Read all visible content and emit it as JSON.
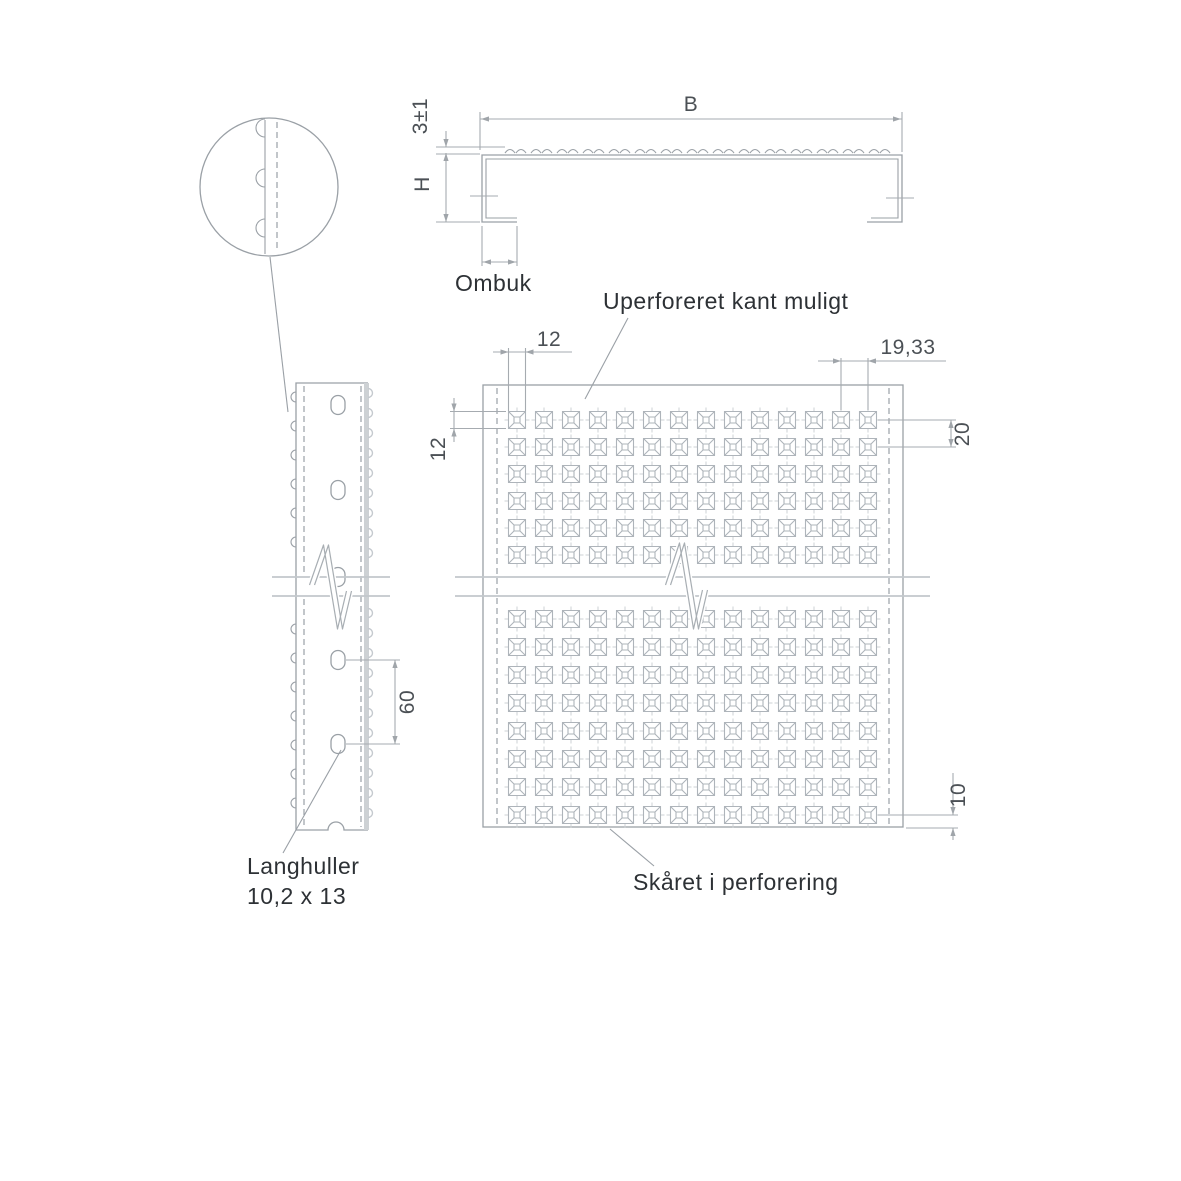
{
  "labels": {
    "ombuk": "Ombuk",
    "unperforated_edge": "Uperforeret kant muligt",
    "cut_in_perforation": "Skåret i perforering",
    "slotted_holes_line1": "Langhuller",
    "slotted_holes_line2": "10,2 x 13"
  },
  "dimensions": {
    "profile_width": "B",
    "rib_height": "3±1",
    "profile_height": "H",
    "perf_width": "12",
    "perf_height": "12",
    "perf_pitch": "19,33",
    "row_pitch": "20",
    "slot_spacing": "60",
    "bottom_edge_distance": "10"
  },
  "colors": {
    "background": "#ffffff",
    "outline": "#9aa0a6",
    "dimension_line": "#a6abb0",
    "perforation": "#aeb4ba",
    "centerline_tick": "#cdd1d4",
    "break_band": "#c3c8cc",
    "label_text": "#2d3135",
    "dimension_text": "#4b5055"
  },
  "perf_grid": {
    "columns": 14,
    "col_start_x": 517,
    "col_pitch": 27,
    "top_row_ys": [
      420,
      447,
      474,
      501,
      528,
      555
    ],
    "bottom_row_ys": [
      619,
      647,
      675,
      703,
      731,
      759,
      787,
      815
    ],
    "outer_size": 17,
    "inner_size": 6
  },
  "strip": {
    "slot_center_x": 338,
    "slot_ys": [
      405,
      490,
      577,
      660,
      744
    ],
    "edge_bump_ys": [
      397,
      426,
      455,
      484,
      513,
      542,
      629,
      658,
      687,
      716,
      745,
      774,
      803
    ],
    "scallop_start_y": 393,
    "scallop_end_y": 824,
    "scallop_pitch": 20
  },
  "cross_section": {
    "wave_start_x": 505,
    "wave_end_x": 869,
    "wave_pitch": 26
  },
  "detail_circle": {
    "bump_ys": [
      128,
      178,
      228
    ]
  }
}
